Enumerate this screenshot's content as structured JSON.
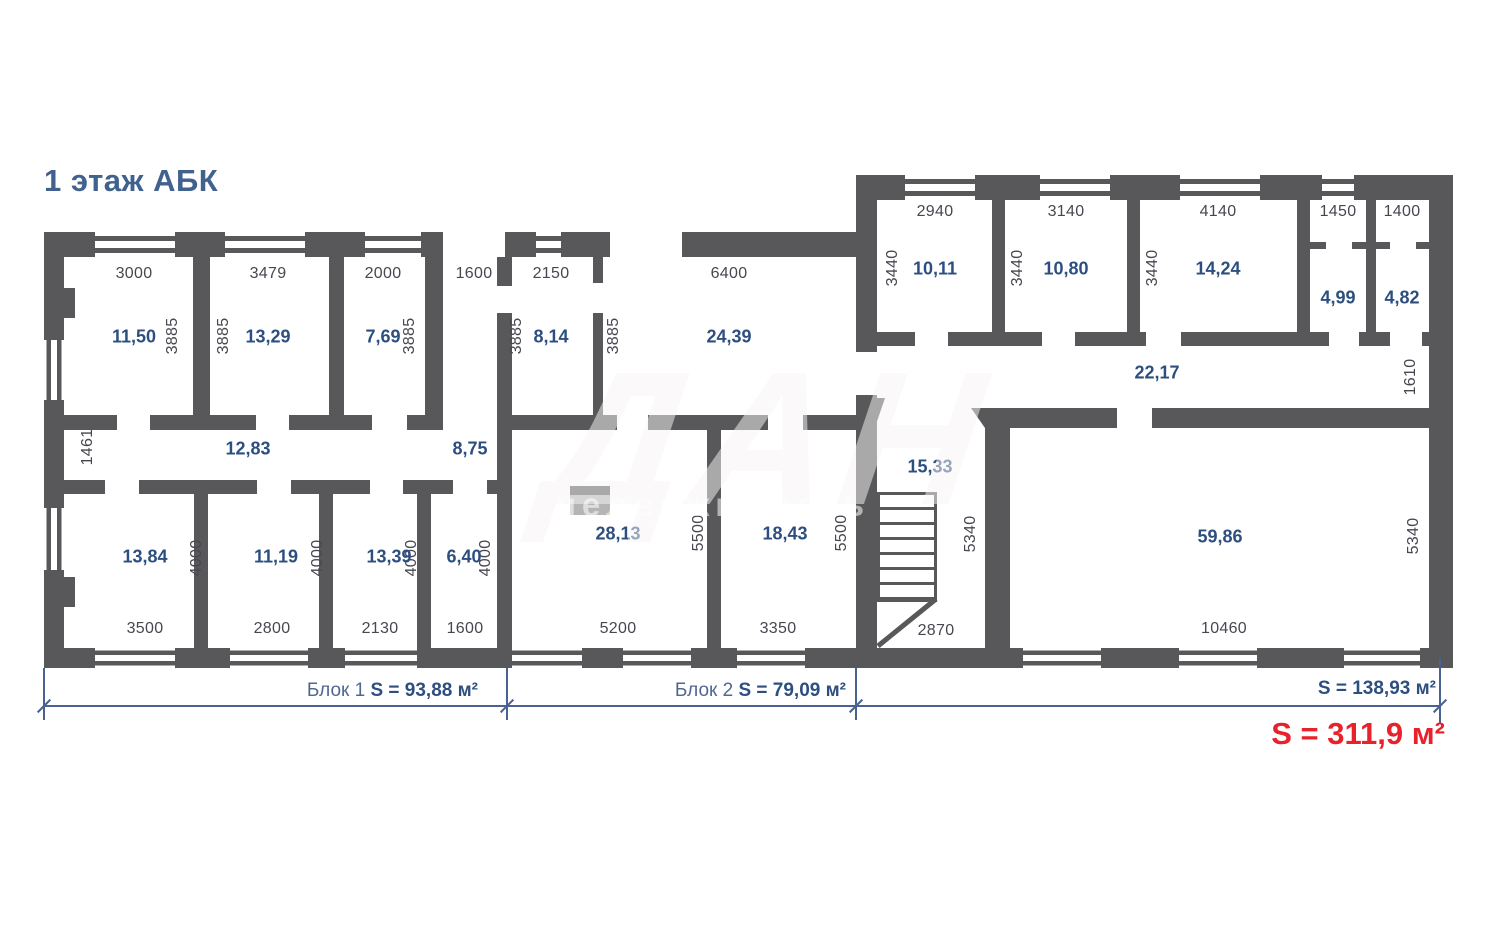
{
  "title": "1 этаж АБК",
  "watermark": {
    "big": "ДАН",
    "small": "недвижимость"
  },
  "palette": {
    "wall": "#58585a",
    "blue": "#2d4f80",
    "dim_text": "#474750",
    "red": "#e8212b",
    "line": "#4a6292"
  },
  "rooms": [
    {
      "area": "11,50",
      "width_mm": "3000",
      "depth_mm": "3885"
    },
    {
      "area": "13,29",
      "width_mm": "3479",
      "depth_mm": "3885"
    },
    {
      "area": "7,69",
      "width_mm": "2000",
      "depth_mm": "3885"
    },
    {
      "width_mm": "1600"
    },
    {
      "area": "8,14",
      "width_mm": "2150",
      "depth_mm": "3885"
    },
    {
      "area": "24,39",
      "width_mm": "6400",
      "depth_mm": "3885"
    },
    {
      "area": "12,83",
      "depth_mm": "1461"
    },
    {
      "area": "8,75"
    },
    {
      "area": "13,84",
      "width_mm": "3500",
      "depth_mm": "4000"
    },
    {
      "area": "11,19",
      "width_mm": "2800",
      "depth_mm": "4000"
    },
    {
      "area": "13,39",
      "width_mm": "2130",
      "depth_mm": "4000"
    },
    {
      "area": "6,40",
      "width_mm": "1600",
      "depth_mm": "4000"
    },
    {
      "area": "28,13",
      "width_mm": "5200",
      "depth_mm": "5500"
    },
    {
      "area": "18,43",
      "width_mm": "3350",
      "depth_mm": "5500"
    },
    {
      "area": "15,33",
      "width_mm": "2870",
      "depth_mm": "5340"
    },
    {
      "area": "22,17",
      "depth_mm": "1610"
    },
    {
      "area": "10,11",
      "width_mm": "2940",
      "depth_mm": "3440"
    },
    {
      "area": "10,80",
      "width_mm": "3140",
      "depth_mm": "3440"
    },
    {
      "area": "14,24",
      "width_mm": "4140",
      "depth_mm": "3440"
    },
    {
      "area": "4,99",
      "width_mm": "1450"
    },
    {
      "area": "4,82",
      "width_mm": "1400"
    },
    {
      "area": "59,86",
      "width_mm": "10460",
      "depth_mm": "5340"
    }
  ],
  "blocks": [
    {
      "label": "Блок 1",
      "area": "S = 93,88 м²"
    },
    {
      "label": "Блок 2",
      "area": "S = 79,09 м²"
    },
    {
      "label": "",
      "area": "S = 138,93 м²"
    }
  ],
  "total_area": "S = 311,9 м²"
}
